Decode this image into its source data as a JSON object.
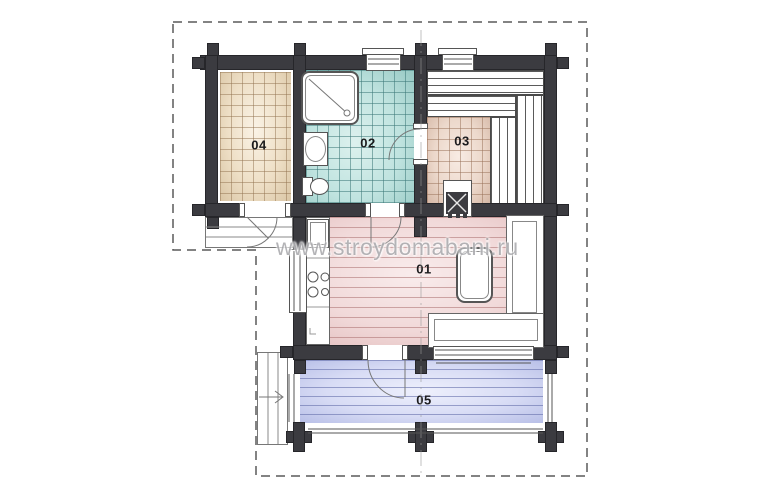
{
  "watermark": "www.stroydomabani.ru",
  "rooms": [
    {
      "label": "01",
      "floor_color": "#f1d9d9"
    },
    {
      "label": "02",
      "floor_color": "#bfe3df"
    },
    {
      "label": "03",
      "floor_color": "#ecd8cb"
    },
    {
      "label": "04",
      "floor_color": "#eedfc6"
    },
    {
      "label": "05",
      "floor_color": "#d8dcf5"
    }
  ],
  "palette": {
    "walls": "#3b3b40",
    "roof_outline_dash": "#5a5a5a",
    "fixture_stroke": "#555555",
    "background": "#ffffff"
  }
}
